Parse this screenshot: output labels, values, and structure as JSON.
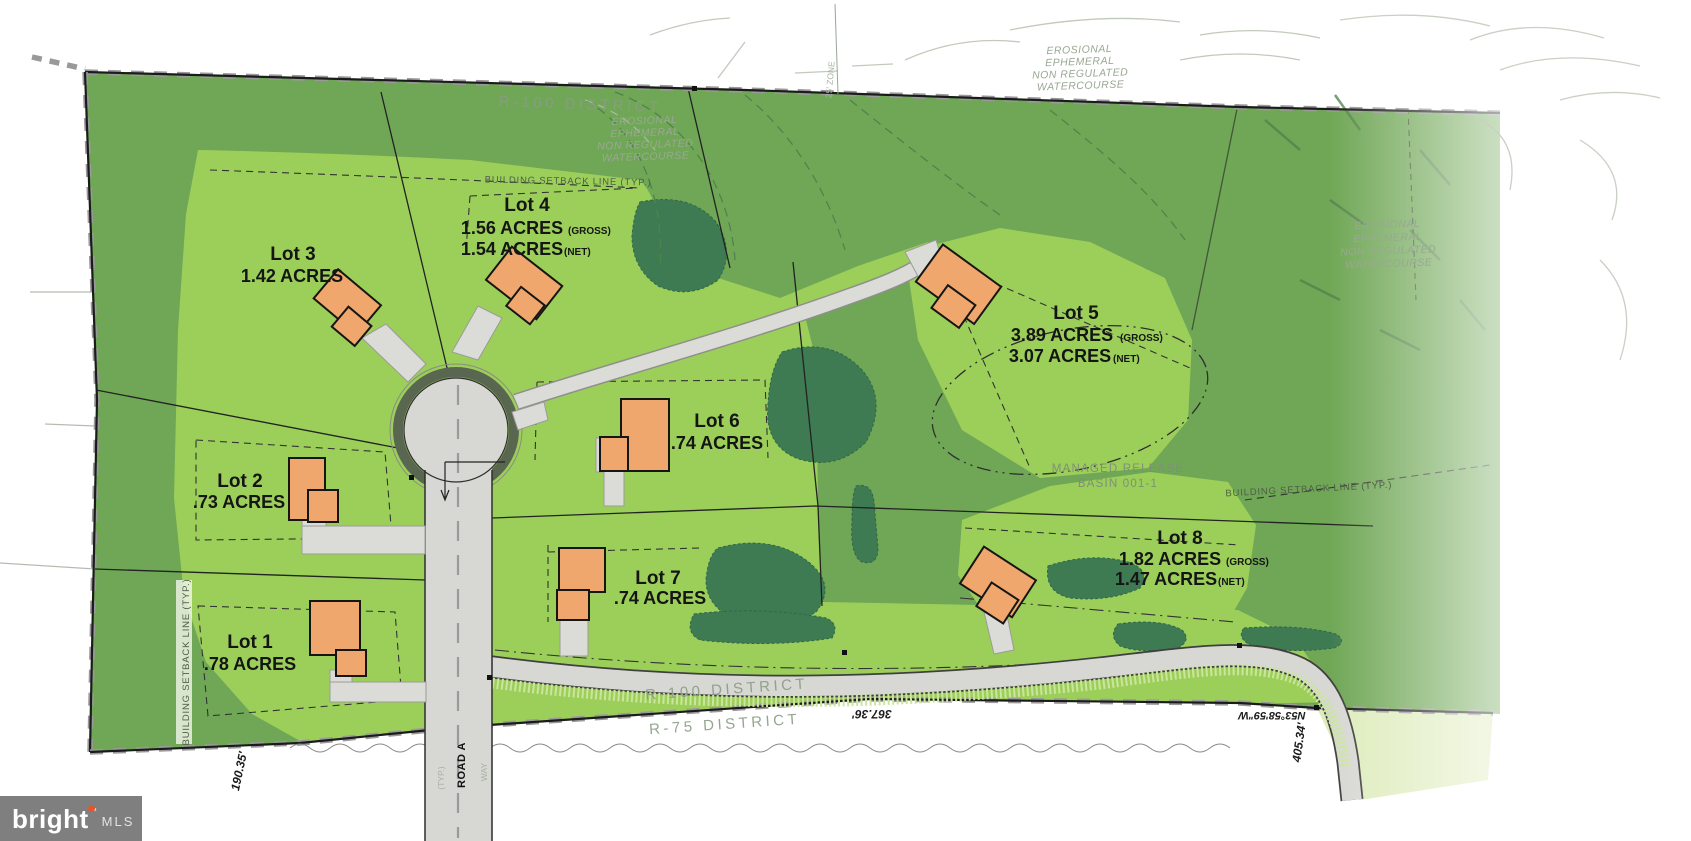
{
  "lots": [
    {
      "name": "Lot 1",
      "acres": ".78 ACRES"
    },
    {
      "name": "Lot 2",
      "acres": ".73 ACRES"
    },
    {
      "name": "Lot 3",
      "acres": "1.42 ACRES"
    },
    {
      "name": "Lot 4",
      "gross": "1.56 ACRES",
      "gross_tag": "(GROSS)",
      "net": "1.54 ACRES",
      "net_tag": "(NET)"
    },
    {
      "name": "Lot 5",
      "gross": "3.89 ACRES",
      "gross_tag": "(GROSS)",
      "net": "3.07 ACRES",
      "net_tag": "(NET)"
    },
    {
      "name": "Lot 6",
      "acres": ".74 ACRES"
    },
    {
      "name": "Lot 7",
      "acres": ".74 ACRES"
    },
    {
      "name": "Lot 8",
      "gross": "1.82 ACRES",
      "gross_tag": "(GROSS)",
      "net": "1.47 ACRES",
      "net_tag": "(NET)"
    }
  ],
  "districts": {
    "top": "R-100 DISTRICT",
    "bottom_r100": "R-100 DISTRICT",
    "bottom_r75": "R-75 DISTRICT"
  },
  "labels": {
    "setback": "BUILDING SETBACK LINE (TYP.)",
    "basin_line1": "MANAGED RELEASE",
    "basin_line2": "BASIN 001-1",
    "zone": "25' ZONE",
    "typ": "(TYP.)",
    "way": "WAY"
  },
  "watercourse": [
    "EROSIONAL",
    "EPHEMERAL",
    "NON REGULATED",
    "WATERCOURSE"
  ],
  "dimensions": {
    "west": "190.35'",
    "south": "367.36'",
    "bearing": "N53°58'59\"W",
    "southeast": "405.34'"
  },
  "road": {
    "name": "ROAD A"
  },
  "watermark": {
    "brand": "bright",
    "tm": "™",
    "suffix": "MLS"
  },
  "colors": {
    "light_green": "#9CCF5A",
    "medium_green": "#70A756",
    "tree_green": "#3E7B52",
    "road_gray": "#D7D7D3",
    "house_orange": "#F0A76D",
    "logo_gray": "#7F7F7F",
    "logo_accent": "#E4572E"
  }
}
